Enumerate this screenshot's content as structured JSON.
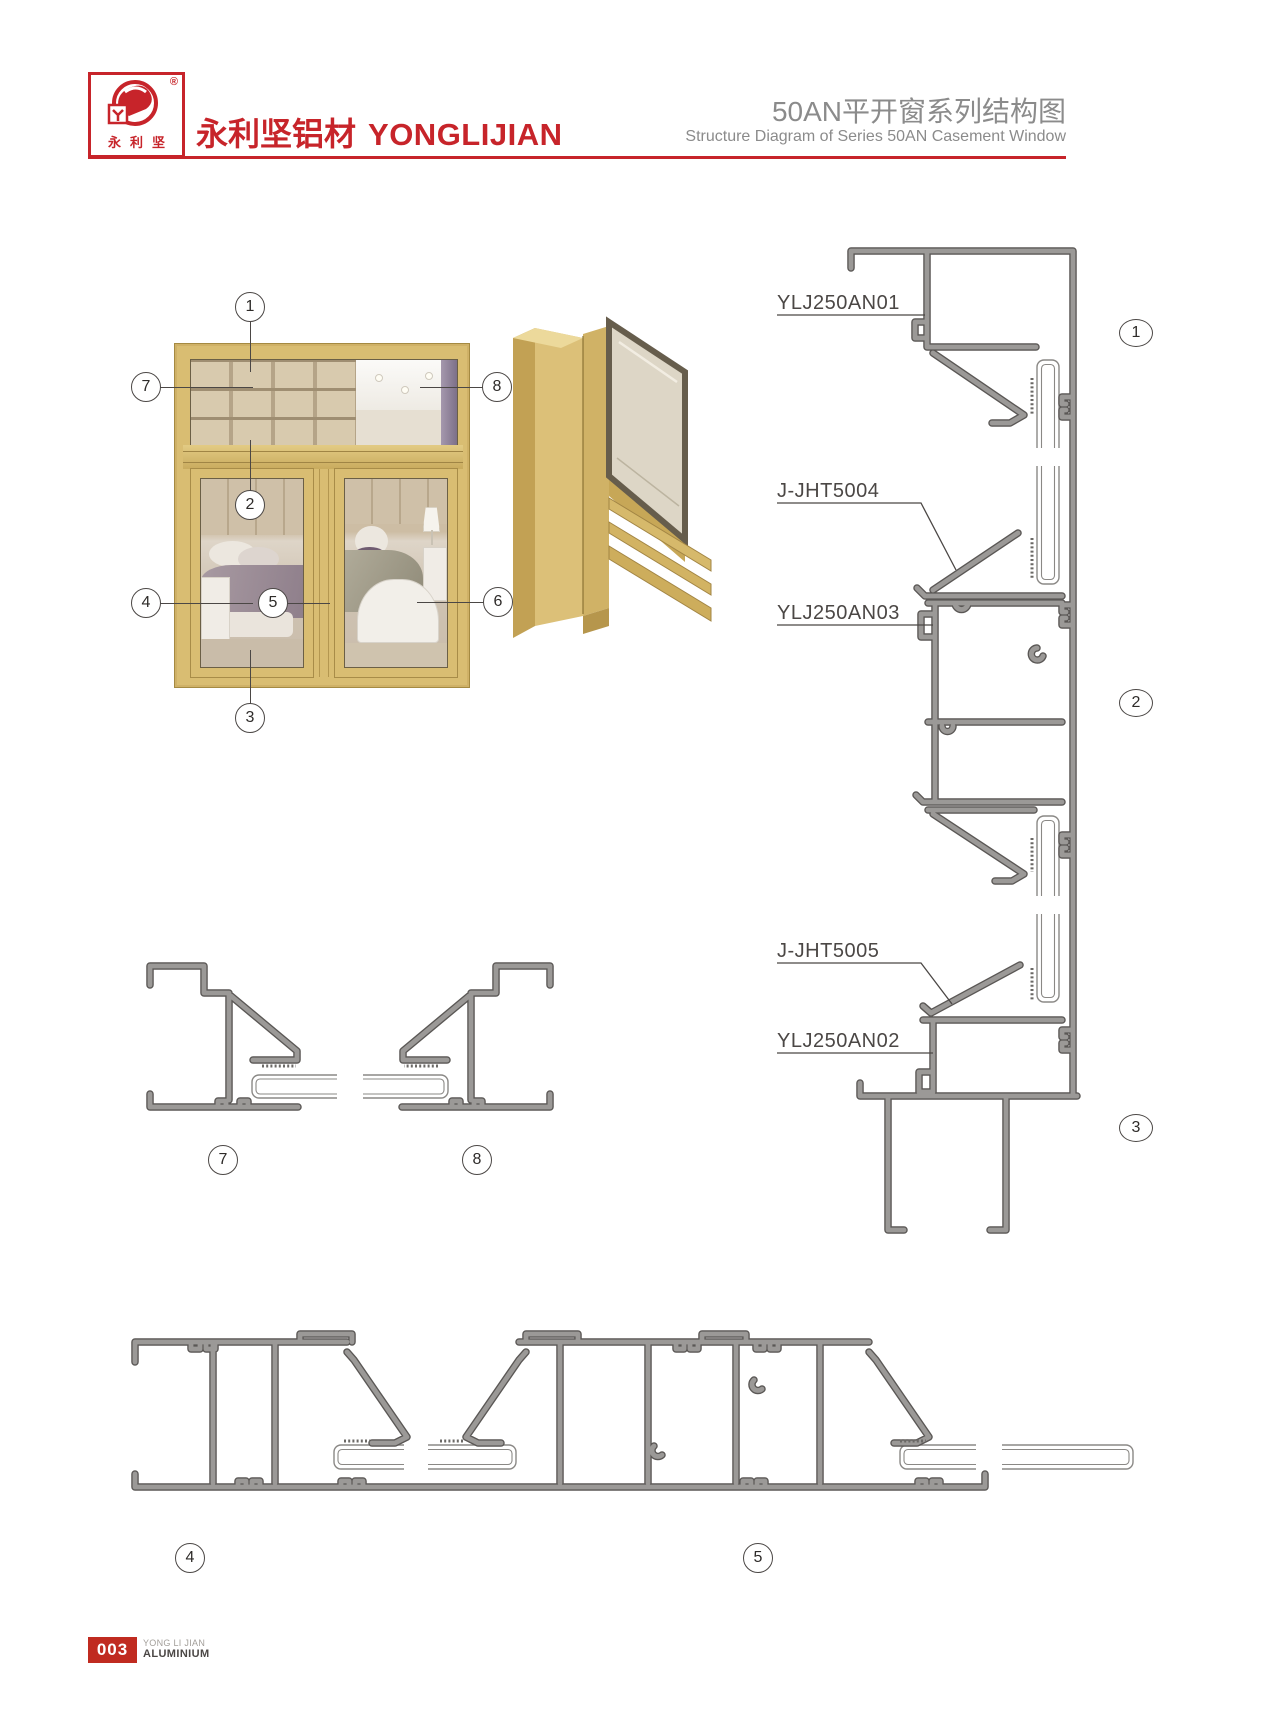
{
  "header": {
    "logo_chars": "永利坚",
    "registered": "®",
    "brand_cn": "永利坚铝材",
    "brand_en": "YONGLIJIAN",
    "title_cn": "50AN平开窗系列结构图",
    "title_en": "Structure Diagram of Series 50AN Casement Window"
  },
  "labels": {
    "an01": "YLJ250AN01",
    "jht5004": "J-JHT5004",
    "an03": "YLJ250AN03",
    "jht5005": "J-JHT5005",
    "an02": "YLJ250AN02"
  },
  "callouts": {
    "c1": "1",
    "c2": "2",
    "c3": "3",
    "c4": "4",
    "c5": "5",
    "c6": "6",
    "c7": "7",
    "c8": "8"
  },
  "footer": {
    "page": "003",
    "brand_line1": "YONG LI JIAN",
    "brand_line2": "ALUMINIUM"
  },
  "colors": {
    "brand_red": "#c7242a",
    "profile_gray": "#9b9997",
    "profile_outline": "#5a5755",
    "frame_gold": "#d9bd72",
    "title_gray": "#8b8b8b"
  }
}
